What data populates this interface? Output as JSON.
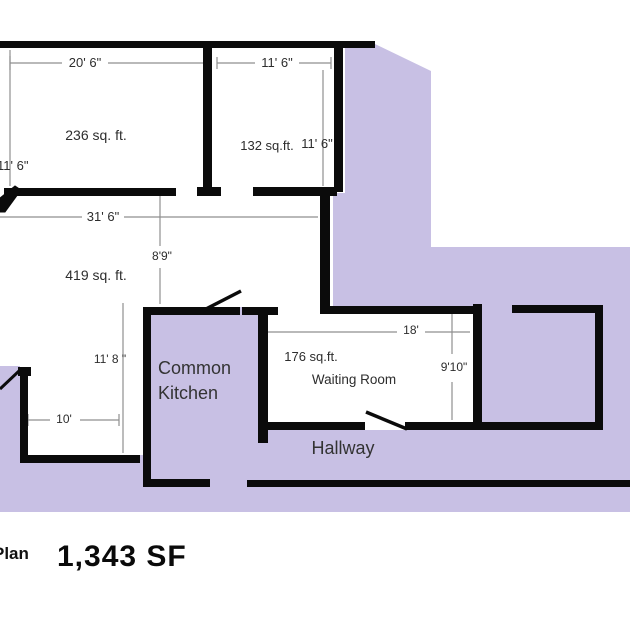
{
  "footer": {
    "plan_label": "Plan",
    "area_value": "1,343 SF"
  },
  "rooms": {
    "room_top_left": {
      "area": "236 sq. ft."
    },
    "room_top_right": {
      "area": "132 sq.ft."
    },
    "room_middle": {
      "area": "419 sq. ft."
    },
    "kitchen": {
      "name_line1": "Common",
      "name_line2": "Kitchen"
    },
    "waiting_room": {
      "area": "176 sq.ft.",
      "name": "Waiting Room"
    },
    "hallway": {
      "name": "Hallway"
    }
  },
  "dimensions": {
    "d20_6": "20' 6\"",
    "d11_6_top": "11' 6\"",
    "d11_6_left": "11' 6\"",
    "d11_6_right": "11' 6\"",
    "d31_6": "31' 6\"",
    "d8_9": "8'9\"",
    "d11_8": "11' 8 \"",
    "d10": "10'",
    "d18": "18'",
    "d9_10": "9'10\""
  },
  "colors": {
    "highlight": "#c8c0e4",
    "wall": "#0b0b0b",
    "dimline": "#8f8f8f",
    "text": "#2d2d2d"
  }
}
